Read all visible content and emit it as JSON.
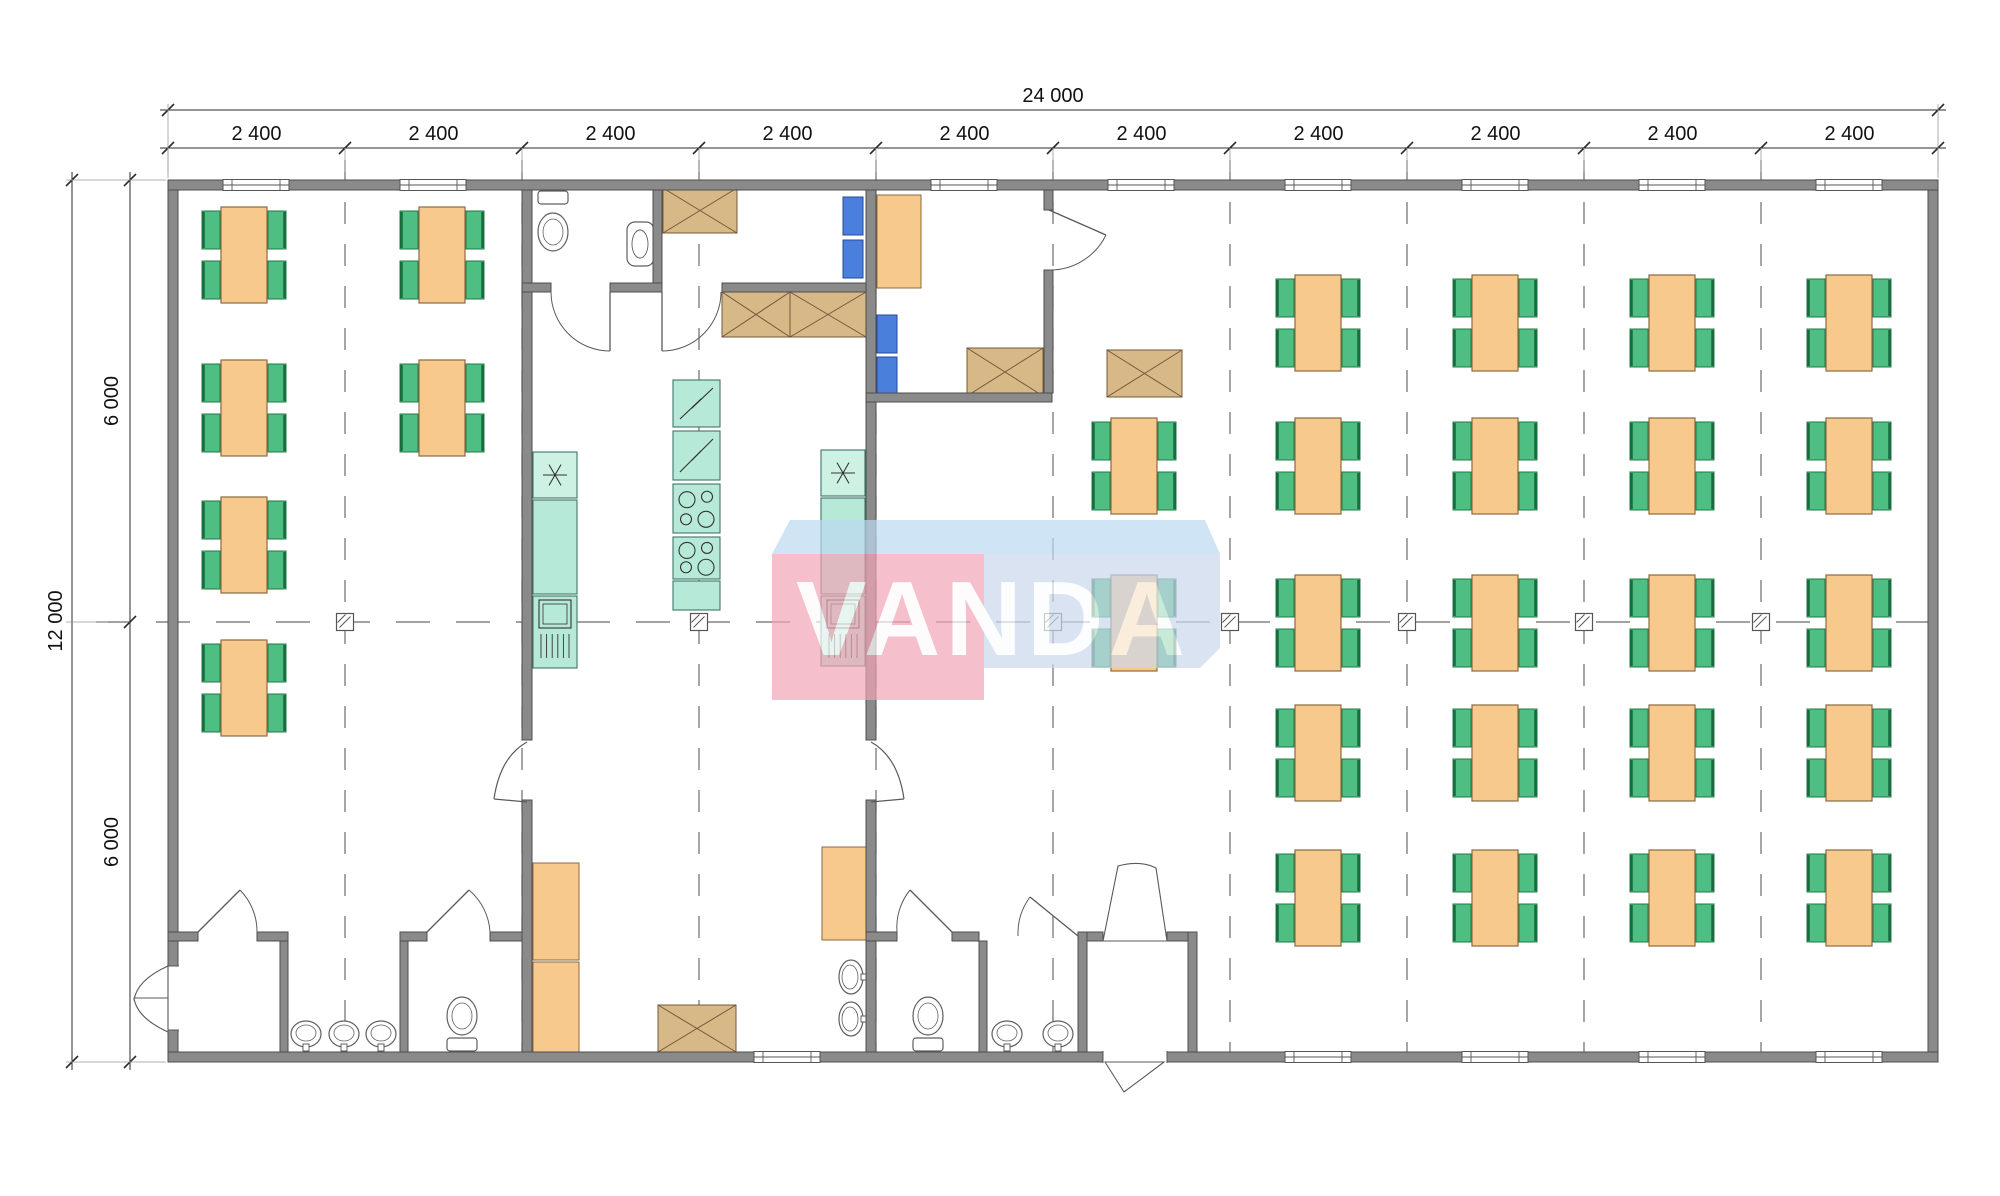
{
  "title": "Modular building floor plan 24000x12000 with dining hall and kitchen",
  "watermark": {
    "text": "VANDA",
    "opacity": 0.7,
    "text_color": "#ffffff",
    "blocks": [
      {
        "name": "top-face",
        "points": "790,520 1205,520 1220,554 772,554",
        "fill": "#bcd9f1"
      },
      {
        "name": "front-left",
        "points": "772,554 984,554 984,700 772,700",
        "fill": "#f1a6b6"
      },
      {
        "name": "front-right",
        "points": "984,554 1220,554 1220,648 1200,668 984,668",
        "fill": "#cbd8ec"
      }
    ],
    "text_x": 993,
    "text_y": 655,
    "font_size": 106,
    "letter_spacing": 5
  },
  "dimensions": {
    "top_total_label": "24 000",
    "top_segment_labels": [
      "2 400",
      "2 400",
      "2 400",
      "2 400",
      "2 400",
      "2 400",
      "2 400",
      "2 400",
      "2 400",
      "2 400"
    ],
    "top_boundaries": [
      168,
      345,
      522,
      699,
      876,
      1053,
      1230,
      1407,
      1584,
      1761,
      1938
    ],
    "top_total_line_y": 110,
    "top_segment_line_y": 148,
    "left_total_label": "12 000",
    "left_segment_labels": [
      "6 000",
      "6 000"
    ],
    "left_boundaries": [
      180,
      622,
      1062
    ],
    "left_total_line_x": 72,
    "left_segment_line_x": 130
  },
  "palette": {
    "wall": "#8a8a8a",
    "wall_stroke": "#4e4e4e",
    "table": "#f8c98c",
    "table_stroke": "#8a6a3f",
    "chair": "#4fbe82",
    "chair_stroke": "#1f7a46",
    "chair_edge": "#166b3c",
    "blue_chair": "#4a80dc",
    "blue_chair_stroke": "#27479e",
    "teal": "#b7e9d8",
    "teal_light": "#cdf2e4",
    "teal_stroke": "#3f7568",
    "tan": "#d7b988",
    "tan_stroke": "#74583a",
    "cabinet": "#f8c98c",
    "cabinet_stroke": "#8a6a3f",
    "fixture_stroke": "#5f5f5f",
    "dim_color": "#2b2b2b",
    "grid_color": "#6a6a6a",
    "glyph": "#3c4a47",
    "door": "#5a5a5a",
    "floor": "#ffffff"
  },
  "grid": {
    "floor": [
      168,
      180,
      1770,
      882
    ],
    "gridline_xs": [
      345,
      522,
      699,
      876,
      1053,
      1230,
      1407,
      1584,
      1761
    ],
    "gridline_y_top": 160,
    "gridline_y_bottom": 1056,
    "centerline_y": 622,
    "centerline_x1": 96,
    "centerline_x2": 1946,
    "marker_xs": [
      345,
      699,
      1053,
      1230,
      1407,
      1584,
      1761
    ],
    "marker_size": 17
  },
  "plan": {
    "table_size": {
      "w": 46,
      "h": 96
    },
    "chair_size": {
      "w": 18,
      "h": 38
    },
    "tables": [
      [
        221,
        207
      ],
      [
        221,
        360
      ],
      [
        221,
        497
      ],
      [
        221,
        640
      ],
      [
        419,
        207
      ],
      [
        419,
        360
      ],
      [
        1111,
        418
      ],
      [
        1111,
        575
      ],
      [
        1295,
        275
      ],
      [
        1295,
        418
      ],
      [
        1295,
        575
      ],
      [
        1295,
        705
      ],
      [
        1295,
        850
      ],
      [
        1472,
        275
      ],
      [
        1472,
        418
      ],
      [
        1472,
        575
      ],
      [
        1472,
        705
      ],
      [
        1472,
        850
      ],
      [
        1649,
        275
      ],
      [
        1649,
        418
      ],
      [
        1649,
        575
      ],
      [
        1649,
        705
      ],
      [
        1649,
        850
      ],
      [
        1826,
        275
      ],
      [
        1826,
        418
      ],
      [
        1826,
        575
      ],
      [
        1826,
        705
      ],
      [
        1826,
        850
      ]
    ],
    "blue_chairs": [
      [
        843,
        197
      ],
      [
        843,
        240
      ],
      [
        877,
        315
      ],
      [
        877,
        357
      ]
    ],
    "cabinets": [
      {
        "name": "kitchen-cabinet",
        "r": [
          533,
          863,
          46,
          97
        ]
      },
      {
        "name": "kitchen-cabinet",
        "r": [
          533,
          962,
          46,
          90
        ]
      },
      {
        "name": "kitchen-cabinet",
        "r": [
          822,
          847,
          44,
          93
        ]
      },
      {
        "name": "office-desk",
        "r": [
          877,
          195,
          44,
          93
        ]
      }
    ],
    "tan_boxes": [
      [
        663,
        188,
        74,
        45
      ],
      [
        722,
        292,
        68,
        45
      ],
      [
        790,
        292,
        76,
        45
      ],
      [
        967,
        348,
        76,
        48
      ],
      [
        1107,
        350,
        75,
        47
      ],
      [
        658,
        1005,
        78,
        47
      ]
    ],
    "teal_units": [
      {
        "name": "kitchen-unit-left",
        "segments": [
          {
            "r": [
              533,
              452,
              44,
              46
            ],
            "glyph": "star"
          },
          {
            "r": [
              533,
              500,
              44,
              94
            ],
            "glyph": null
          },
          {
            "r": [
              533,
              596,
              44,
              72
            ],
            "glyph": "sink"
          }
        ]
      },
      {
        "name": "kitchen-island",
        "segments": [
          {
            "r": [
              673,
              380,
              47,
              47
            ],
            "glyph": "zig"
          },
          {
            "r": [
              673,
              431,
              47,
              49
            ],
            "glyph": "zig"
          },
          {
            "r": [
              673,
              484,
              47,
              49
            ],
            "glyph": "stove"
          },
          {
            "r": [
              673,
              537,
              47,
              42
            ],
            "glyph": "stove"
          },
          {
            "r": [
              673,
              581,
              47,
              29
            ],
            "glyph": null
          }
        ]
      },
      {
        "name": "kitchen-unit-right",
        "segments": [
          {
            "r": [
              821,
              450,
              44,
              46
            ],
            "glyph": "star"
          },
          {
            "r": [
              821,
              498,
              44,
              96
            ],
            "glyph": null
          },
          {
            "r": [
              821,
              596,
              44,
              70
            ],
            "glyph": "sink"
          }
        ]
      }
    ],
    "walls": [
      [
        168,
        180,
        1770,
        10
      ],
      [
        168,
        1052,
        1770,
        10
      ],
      [
        168,
        190,
        10,
        862
      ],
      [
        1928,
        190,
        10,
        862
      ],
      [
        522,
        190,
        10,
        550
      ],
      [
        522,
        800,
        10,
        252
      ],
      [
        866,
        190,
        10,
        550
      ],
      [
        866,
        800,
        10,
        252
      ],
      [
        653,
        190,
        9,
        102
      ],
      [
        522,
        283,
        29,
        9
      ],
      [
        610,
        283,
        52,
        9
      ],
      [
        722,
        283,
        144,
        9
      ],
      [
        866,
        393,
        186,
        9
      ],
      [
        1044,
        190,
        9,
        20
      ],
      [
        1044,
        270,
        9,
        123
      ],
      [
        168,
        932,
        30,
        9
      ],
      [
        257,
        932,
        31,
        9
      ],
      [
        280,
        941,
        8,
        111
      ],
      [
        400,
        941,
        8,
        111
      ],
      [
        400,
        932,
        27,
        9
      ],
      [
        490,
        932,
        32,
        9
      ],
      [
        866,
        932,
        31,
        9
      ],
      [
        952,
        932,
        27,
        9
      ],
      [
        979,
        941,
        8,
        111
      ],
      [
        1078,
        932,
        9,
        120
      ],
      [
        1087,
        932,
        16,
        9
      ],
      [
        1167,
        932,
        30,
        9
      ],
      [
        1188,
        932,
        9,
        120
      ]
    ],
    "windows_top": [
      [
        223,
        180,
        66,
        10
      ],
      [
        400,
        180,
        66,
        10
      ],
      [
        931,
        180,
        66,
        10
      ],
      [
        1108,
        180,
        66,
        10
      ],
      [
        1285,
        180,
        66,
        10
      ],
      [
        1462,
        180,
        66,
        10
      ],
      [
        1639,
        180,
        66,
        10
      ],
      [
        1816,
        180,
        66,
        10
      ]
    ],
    "windows_bottom": [
      [
        754,
        1052,
        66,
        10
      ],
      [
        1285,
        1052,
        66,
        10
      ],
      [
        1462,
        1052,
        66,
        10
      ],
      [
        1639,
        1052,
        66,
        10
      ],
      [
        1816,
        1052,
        66,
        10
      ]
    ],
    "wall_openings": [
      {
        "r": [
          167,
          966,
          12,
          64
        ],
        "jambs": [
          [
            167,
            966,
            179,
            966
          ],
          [
            167,
            1030,
            179,
            1030
          ]
        ]
      },
      {
        "r": [
          1103,
          1051,
          64,
          12
        ],
        "jambs": [
          [
            1103,
            1051,
            1103,
            1063
          ],
          [
            1167,
            1051,
            1167,
            1063
          ]
        ]
      }
    ],
    "arc_doors": [
      {
        "h": [
          610,
          292
        ],
        "s": [
          610,
          351
        ],
        "e": [
          551,
          292
        ]
      },
      {
        "h": [
          662,
          292
        ],
        "s": [
          662,
          351
        ],
        "e": [
          721,
          292
        ]
      },
      {
        "h": [
          1049,
          210
        ],
        "s": [
          1106,
          235
        ],
        "e": [
          1049,
          270
        ]
      },
      {
        "h": [
          198,
          932
        ],
        "s": [
          240,
          890
        ],
        "e": [
          257,
          932
        ]
      },
      {
        "h": [
          427,
          932
        ],
        "s": [
          469,
          890
        ],
        "e": [
          490,
          932
        ]
      },
      {
        "h": [
          952,
          932
        ],
        "s": [
          910,
          890
        ],
        "e": [
          897,
          932
        ]
      },
      {
        "h": [
          1078,
          936
        ],
        "s": [
          1030,
          897
        ],
        "e": [
          1018,
          936
        ]
      }
    ],
    "path_doors": [
      "M527,742 Q500,757 494,799 M494,799 L527,802",
      "M871,742 Q898,757 904,799 M904,799 L871,802"
    ],
    "poly_doors": [
      "M168,966 Q137,980 134,1000 L168,1000 Z",
      "M168,1032 Q137,1018 134,998 L168,998 Z",
      "M1103,941 L1118,866 Q1140,860 1156,868 L1167,941 Z",
      "M1105,1062 L1124,1092 L1164,1062 Z"
    ],
    "wcs": [
      {
        "tank": [
          538,
          191,
          30,
          13
        ],
        "bowl": [
          553,
          232
        ]
      },
      {
        "tank": [
          447,
          1038,
          30,
          13
        ],
        "bowl": [
          462,
          1016
        ]
      },
      {
        "tank": [
          913,
          1038,
          30,
          13
        ],
        "bowl": [
          928,
          1016
        ]
      }
    ],
    "wall_sink": {
      "rect": [
        627,
        222,
        27,
        44
      ],
      "oval": [
        640,
        244
      ]
    },
    "basins": [
      {
        "c": [
          306,
          1034
        ],
        "dir": "up"
      },
      {
        "c": [
          344,
          1034
        ],
        "dir": "up"
      },
      {
        "c": [
          381,
          1034
        ],
        "dir": "up"
      },
      {
        "c": [
          1007,
          1034
        ],
        "dir": "up"
      },
      {
        "c": [
          1058,
          1034
        ],
        "dir": "up"
      },
      {
        "c": [
          851,
          977
        ],
        "dir": "west"
      },
      {
        "c": [
          851,
          1019
        ],
        "dir": "west"
      }
    ]
  }
}
